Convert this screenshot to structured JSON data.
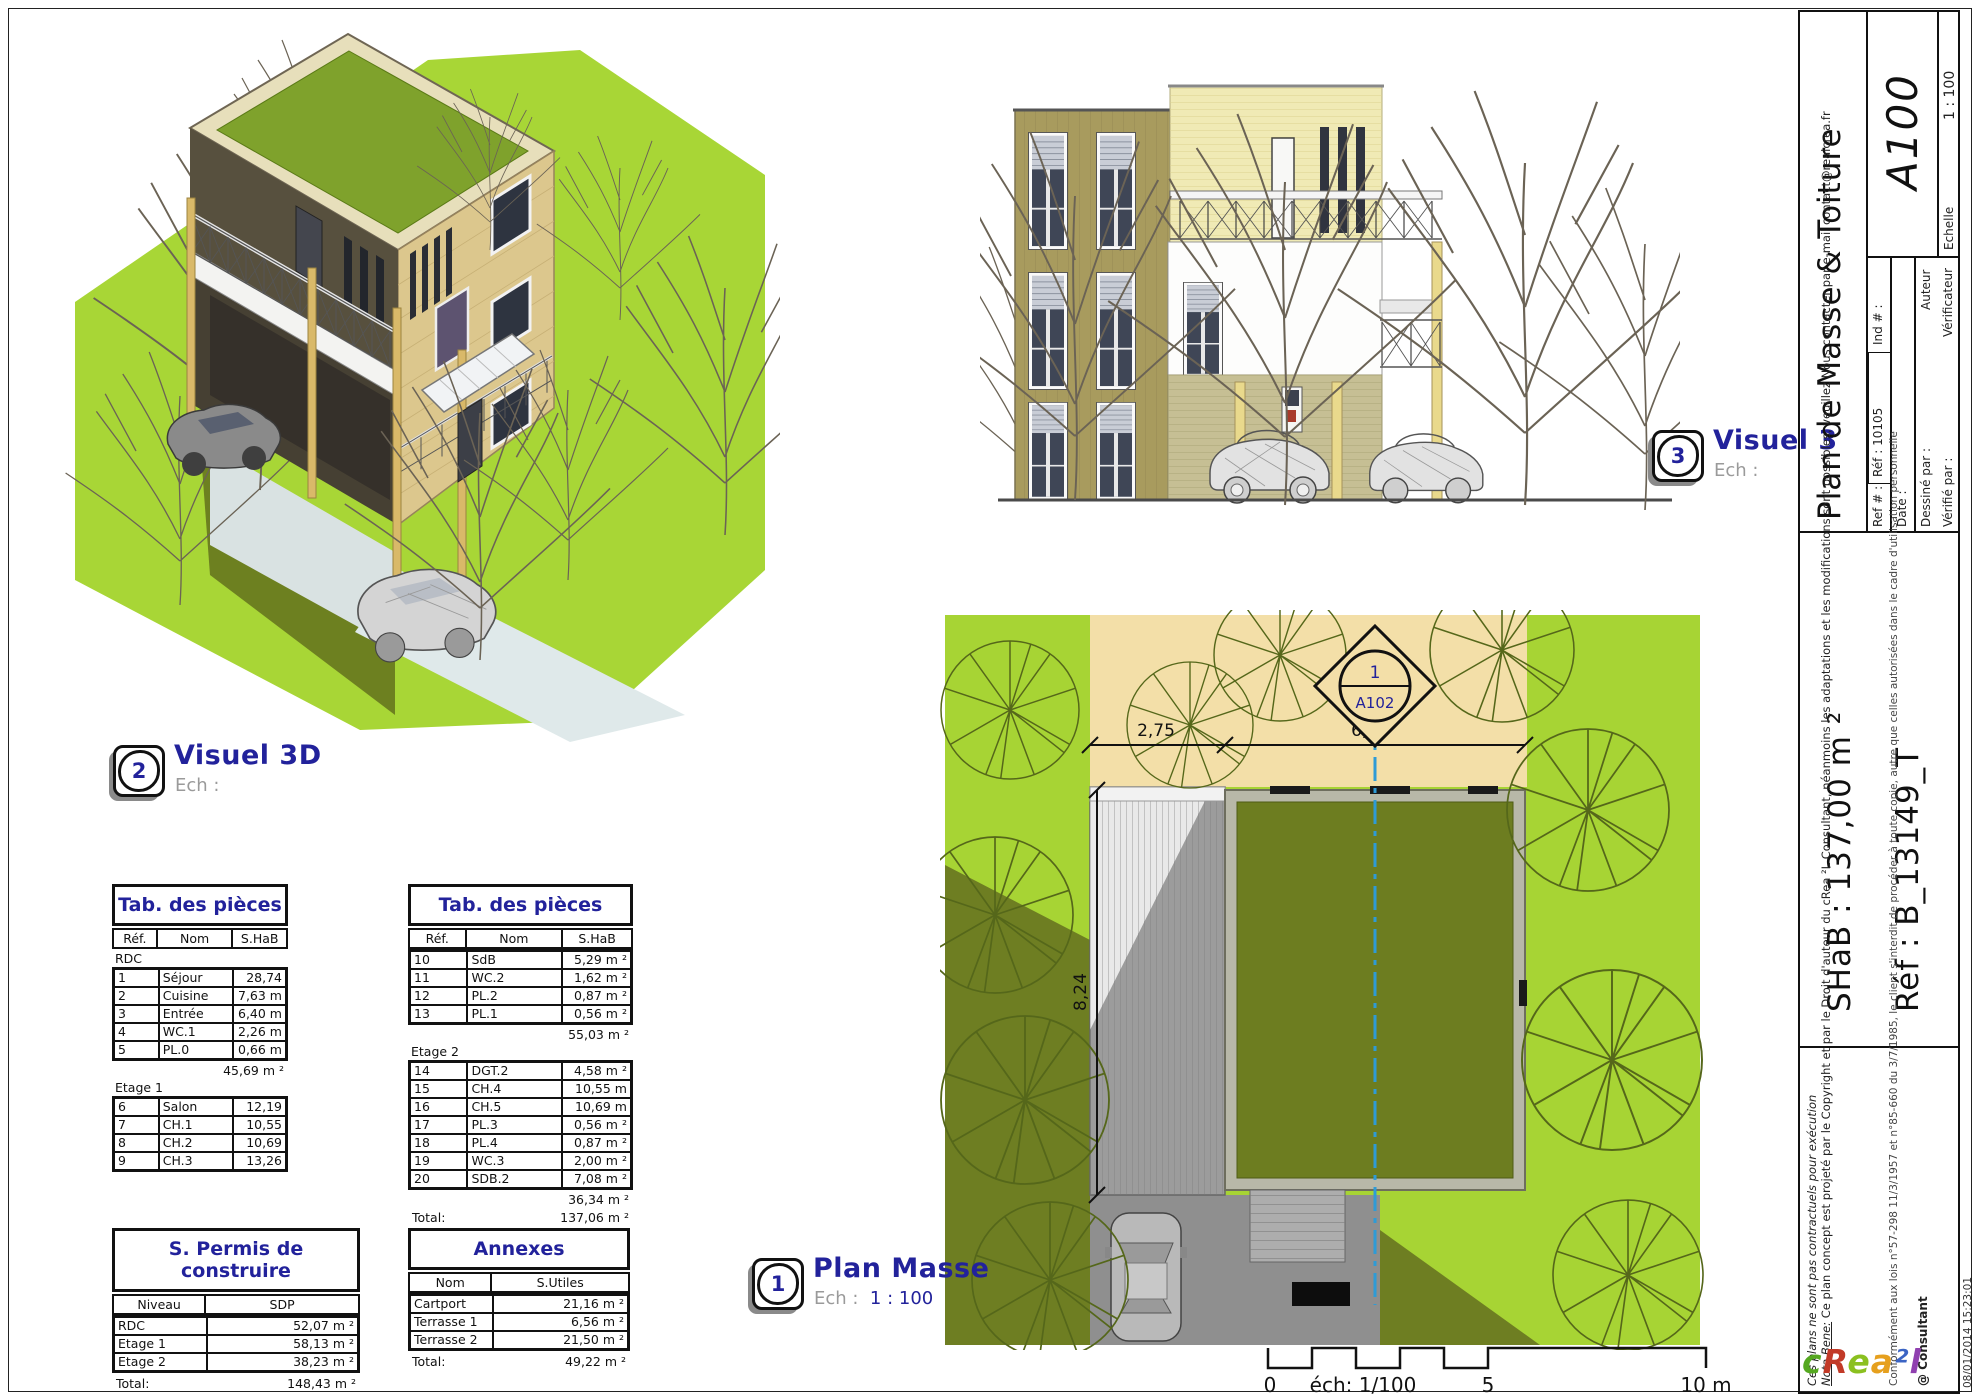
{
  "colors": {
    "accent_navy": "#22229b",
    "lawn_green": "#a7d434",
    "roof_olive": "#6d7d20",
    "street_beige": "#f3dfa8",
    "centerline_blue": "#2e9bd6"
  },
  "labels": {
    "visuel3d": {
      "num": "2",
      "title": "Visuel 3D",
      "ech_label": "Ech :",
      "ech_value": ""
    },
    "visuel3": {
      "num": "3",
      "title": "Visuel 3",
      "ech_label": "Ech :",
      "ech_value": ""
    },
    "plan_masse": {
      "num": "1",
      "title": "Plan Masse",
      "ech_label": "Ech :",
      "ech_value": "1 : 100"
    }
  },
  "plan": {
    "dim_left": "2,75",
    "dim_right": "6,39",
    "dim_vert": "8,24",
    "marker_num": "1",
    "marker_sheet": "A102"
  },
  "scalebar": {
    "zero": "0",
    "mid_label": "éch: 1/100",
    "five": "5",
    "ten": "10 m"
  },
  "tab_left": {
    "title": "Tab. des pièces",
    "headers": [
      "Réf.",
      "Nom",
      "S.HaB"
    ],
    "group1_label": "RDC",
    "group1_rows": [
      [
        "1",
        "Séjour",
        "28,74 m ²"
      ],
      [
        "2",
        "Cuisine",
        "7,63 m ²"
      ],
      [
        "3",
        "Entrée",
        "6,40 m ²"
      ],
      [
        "4",
        "WC.1",
        "2,26 m ²"
      ],
      [
        "5",
        "PL.0",
        "0,66 m ²"
      ]
    ],
    "group1_subtotal": "45,69 m ²",
    "group2_label": "Etage 1",
    "group2_rows": [
      [
        "6",
        "Salon",
        "12,19 m ²"
      ],
      [
        "7",
        "CH.1",
        "10,55 m ²"
      ],
      [
        "8",
        "CH.2",
        "10,69 m ²"
      ],
      [
        "9",
        "CH.3",
        "13,26 m ²"
      ]
    ]
  },
  "tab_right": {
    "title": "Tab. des pièces",
    "headers": [
      "Réf.",
      "Nom",
      "S.HaB"
    ],
    "group1_rows": [
      [
        "10",
        "SdB",
        "5,29 m ²"
      ],
      [
        "11",
        "WC.2",
        "1,62 m ²"
      ],
      [
        "12",
        "PL.2",
        "0,87 m ²"
      ],
      [
        "13",
        "PL.1",
        "0,56 m ²"
      ]
    ],
    "group1_subtotal": "55,03 m ²",
    "group2_label": "Etage 2",
    "group2_rows": [
      [
        "14",
        "DGT.2",
        "4,58 m ²"
      ],
      [
        "15",
        "CH.4",
        "10,55 m ²"
      ],
      [
        "16",
        "CH.5",
        "10,69 m ²"
      ],
      [
        "17",
        "PL.3",
        "0,56 m ²"
      ],
      [
        "18",
        "PL.4",
        "0,87 m ²"
      ],
      [
        "19",
        "WC.3",
        "2,00 m ²"
      ],
      [
        "20",
        "SDB.2",
        "7,08 m ²"
      ]
    ],
    "group2_subtotal": "36,34 m ²",
    "total_label": "Total:",
    "total_value": "137,06 m ²"
  },
  "permis": {
    "title": "S. Permis de construire",
    "headers": [
      "Niveau",
      "SDP"
    ],
    "rows": [
      [
        "RDC",
        "52,07 m ²"
      ],
      [
        "Etage 1",
        "58,13 m ²"
      ],
      [
        "Etage 2",
        "38,23 m ²"
      ]
    ],
    "total_label": "Total:",
    "total_value": "148,43 m ²"
  },
  "annexes": {
    "title": "Annexes",
    "headers": [
      "Nom",
      "S.Utiles"
    ],
    "rows": [
      [
        "Cartport",
        "21,16 m ²"
      ],
      [
        "Terrasse 1",
        "6,56 m ²"
      ],
      [
        "Terrasse 2",
        "21,50 m ²"
      ]
    ],
    "total_label": "Total:",
    "total_value": "49,22 m ²"
  },
  "title_block": {
    "sheet_title": "Plan de Masse & Toiture",
    "sheet_number": "A100",
    "scale_label": "Echelle",
    "scale_value": "1 : 100",
    "ref_label": "Ref # :",
    "ref_value": "Réf : 10105",
    "ind_label": "Ind # :",
    "date_label": "Date :",
    "drawn_label": "Dessiné par :",
    "drawn_value": "Auteur",
    "checked_label": "Vérifié par :",
    "checked_value": "Vérificateur",
    "shab": "SHaB : 137,00 m ²",
    "ref_b": "Réf : B_13149_T",
    "legal_1": "Ces plans ne sont pas contractuels pour exécution",
    "legal_2a": "Nota Bene:",
    "legal_2b": " Ce plan concept est projeté par le Copyright et par le Droit d'auteur du cRea ²L Consultant, néanmoins les adaptations et les modifications sont possibles, veuillez Nous contacter par e-mail contact@realcrea.fr",
    "legal_3": "Conformément aux lois n°57-298 11/3/1957 et n°85-660 du 3/7/1985, le client s'interdit de procéder à toute copie, autre que celles autorisées dans le cadre d'utilisation personnelle",
    "consultant": "@ Consultant",
    "logo_c1": "c",
    "logo_c2": "R",
    "logo_c3": "e",
    "logo_c4": "a",
    "logo_c5": "²",
    "logo_c6": "l",
    "timestamp": "08/01/2014 15:23:01"
  }
}
